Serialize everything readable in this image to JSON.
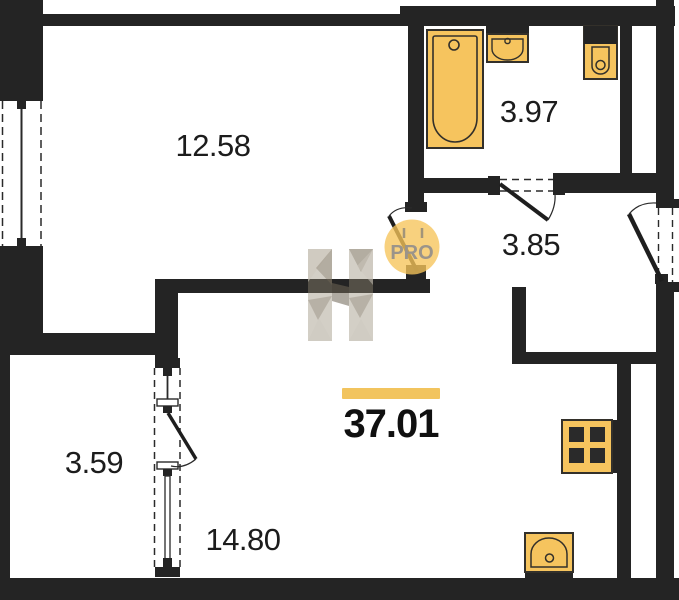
{
  "plan": {
    "total_area": "37.01",
    "rooms": [
      {
        "name": "room",
        "area": "12.58"
      },
      {
        "name": "bathroom",
        "area": "3.97"
      },
      {
        "name": "hallway",
        "area": "3.85"
      },
      {
        "name": "balcony",
        "area": "3.59"
      },
      {
        "name": "living-room",
        "area": "14.80"
      }
    ],
    "watermark": {
      "badge": "PRO"
    },
    "fixtures": [
      "bathtub",
      "washbasin",
      "toilet",
      "stove",
      "kitchen-sink"
    ],
    "colors": {
      "wall": "#242424",
      "fixture_fill": "#f6c45e",
      "fixture_stroke": "#33302a",
      "accent_bar": "#f2c45e",
      "watermark_beige": "#a89e8c",
      "badge_fill": "#f4c35c",
      "badge_text": "#9b948a"
    }
  }
}
